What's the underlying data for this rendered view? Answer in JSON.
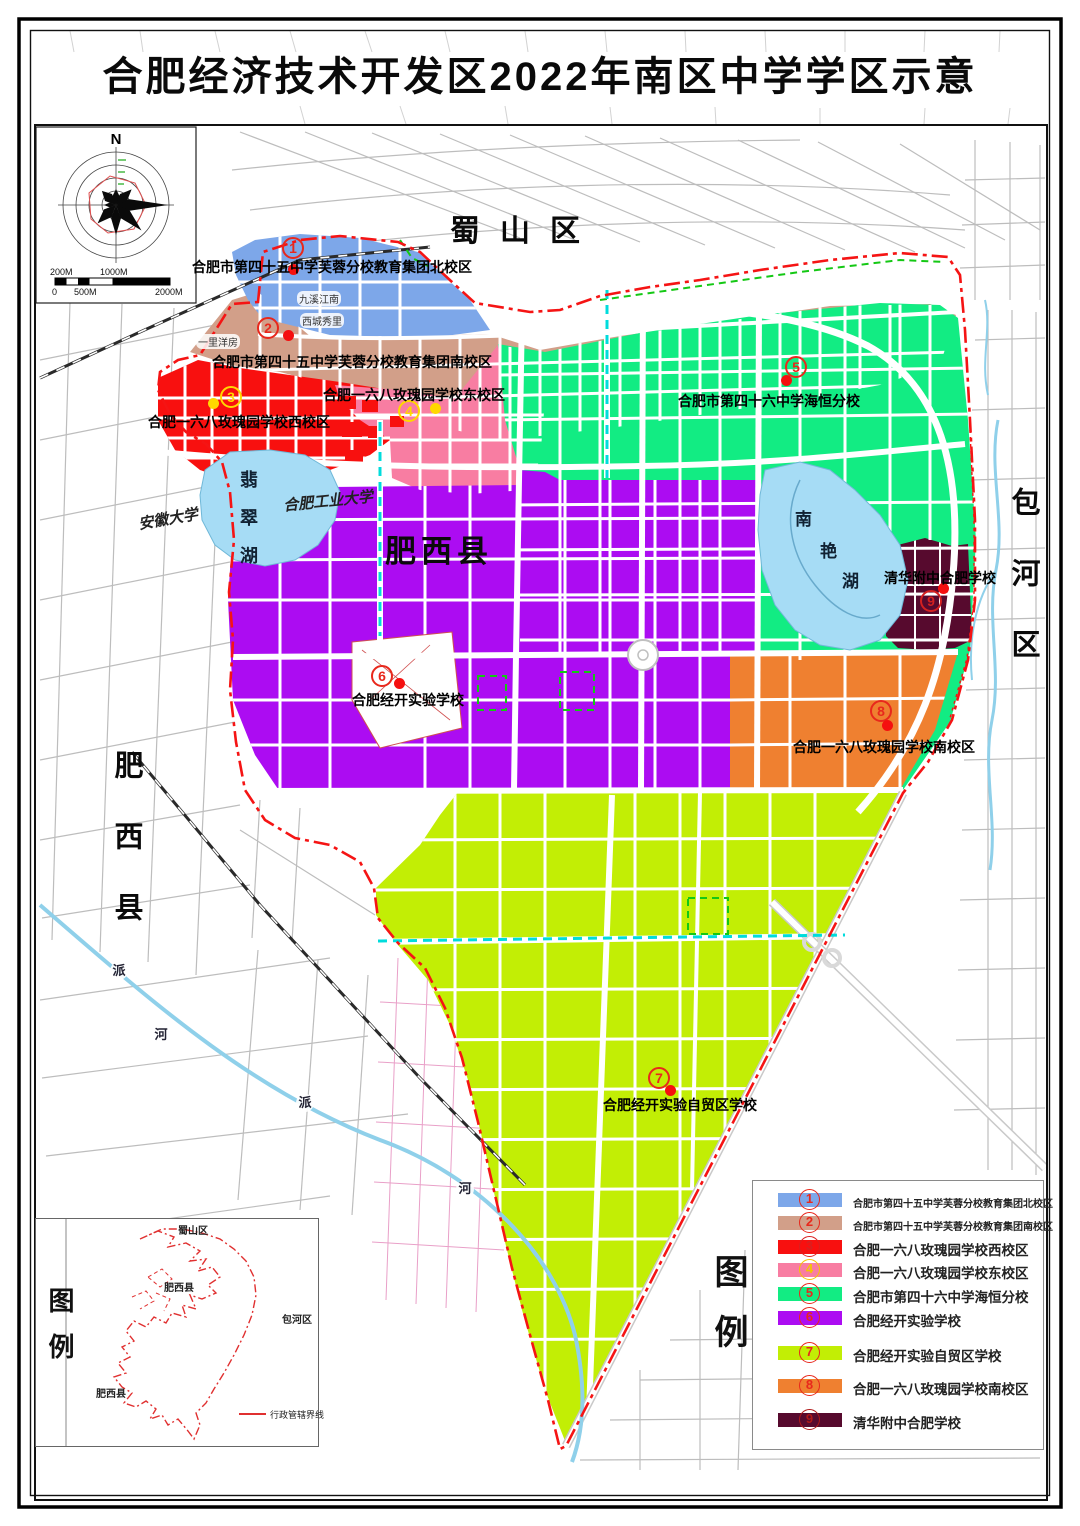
{
  "title": "合肥经济技术开发区2022年南区中学学区示意",
  "compass": {
    "north": "N"
  },
  "scalebar": {
    "top": [
      "200M",
      "1000M"
    ],
    "bottom": [
      "0",
      "500M",
      "2000M"
    ]
  },
  "map": {
    "labels": {
      "shushan": "蜀山区",
      "feixi_center": "肥西县",
      "feixi_west": "肥西县",
      "baohe_east": "包河区",
      "jade_lake": "翡翠湖",
      "nanyan": "南艳湖",
      "anhui_university": "安徽大学",
      "hefei_university_of_technology": "合肥工业大学",
      "jiuxi_jiangnan": "九溪江南",
      "xicheng_xiuli": "西城秀里",
      "yili_yangfang": "一里洋房",
      "river_pai_1": "派",
      "river_he_1": "河",
      "river_pai_2": "派",
      "river_he_2": "河"
    },
    "colors": {
      "water": "#a6dcf5",
      "boundary": "#f51414",
      "cyan_line": "#00d8d8",
      "green_dash": "#14c814",
      "rail": "#2a2a2a",
      "road_casing": "#c9c9c9"
    }
  },
  "schools": [
    {
      "num": "1",
      "name": "合肥市第四十五中学芙蓉分校教育集团北校区",
      "marker_color": "#e8281c",
      "dot_color": "#f50f0f"
    },
    {
      "num": "2",
      "name": "合肥市第四十五中学芙蓉分校教育集团南校区",
      "marker_color": "#e8281c",
      "dot_color": "#f50f0f"
    },
    {
      "num": "3",
      "name": "合肥一六八玫瑰园学校西校区",
      "marker_color": "#ffd800",
      "dot_color": "#ffd800"
    },
    {
      "num": "4",
      "name": "合肥一六八玫瑰园学校东校区",
      "marker_color": "#ffd800",
      "dot_color": "#ffd800"
    },
    {
      "num": "5",
      "name": "合肥市第四十六中学海恒分校",
      "marker_color": "#e8281c",
      "dot_color": "#f50f0f"
    },
    {
      "num": "6",
      "name": "合肥经开实验学校",
      "marker_color": "#e8281c",
      "dot_color": "#f50f0f"
    },
    {
      "num": "7",
      "name": "合肥经开实验自贸区学校",
      "marker_color": "#e8281c",
      "dot_color": "#f50f0f"
    },
    {
      "num": "8",
      "name": "合肥一六八玫瑰园学校南校区",
      "marker_color": "#e8281c",
      "dot_color": "#f50f0f"
    },
    {
      "num": "9",
      "name": "清华附中合肥学校",
      "marker_color": "#d42020",
      "dot_color": "#f50f0f"
    }
  ],
  "legend": {
    "title": "图例",
    "items": [
      {
        "num": "1",
        "label": "合肥市第四十五中学芙蓉分校教育集团北校区",
        "color": "#7da7e9",
        "num_color": "#e8281c"
      },
      {
        "num": "2",
        "label": "合肥市第四十五中学芙蓉分校教育集团南校区",
        "color": "#d29f89",
        "num_color": "#e8281c"
      },
      {
        "num": "3",
        "label": "合肥一六八玫瑰园学校西校区",
        "color": "#f8100f",
        "num_color": "#d82020"
      },
      {
        "num": "4",
        "label": "合肥一六八玫瑰园学校东校区",
        "color": "#f87da2",
        "num_color": "#f5c400"
      },
      {
        "num": "5",
        "label": "合肥市第四十六中学海恒分校",
        "color": "#12ec83",
        "num_color": "#e8281c"
      },
      {
        "num": "6",
        "label": "合肥经开实验学校",
        "color": "#ac0cf2",
        "num_color": "#e8281c"
      },
      {
        "num": "7",
        "label": "合肥经开实验自贸区学校",
        "color": "#c2ee05",
        "num_color": "#e8281c"
      },
      {
        "num": "8",
        "label": "合肥一六八玫瑰园学校南校区",
        "color": "#ef8030",
        "num_color": "#e8281c"
      },
      {
        "num": "9",
        "label": "清华附中合肥学校",
        "color": "#570a2e",
        "num_color": "#b01818"
      }
    ]
  },
  "inset": {
    "title": "图例",
    "labels": {
      "shushan": "蜀山区",
      "feixi": "肥西县",
      "baohe": "包河区",
      "feixi_sw": "肥西县"
    },
    "boundary_label": "行政管辖界线"
  }
}
